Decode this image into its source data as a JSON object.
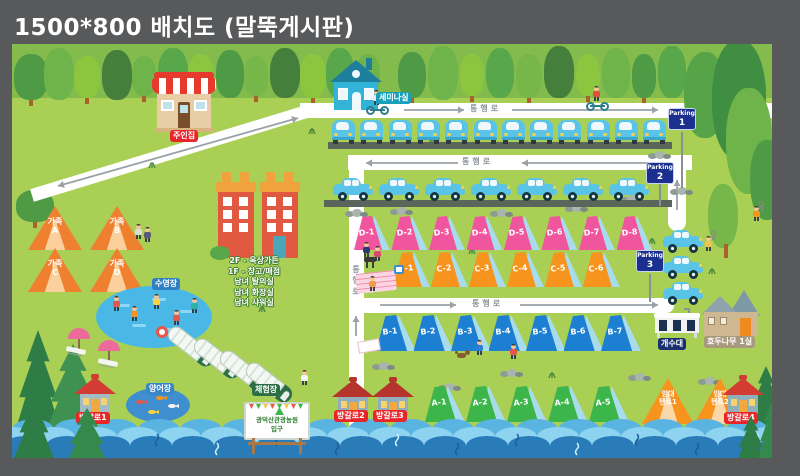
{
  "title": "1500*800 배치도 (말뚝게시판)",
  "road_label": "통행로",
  "parking": {
    "word": "Parking",
    "numbers": [
      "1",
      "2",
      "3"
    ]
  },
  "places": {
    "owner_house": "주인집",
    "seminar_room": "세미나실",
    "pool": "수영장",
    "fish_pond": "양어장",
    "experience_zone": "체험장",
    "sink_station": "개수대",
    "walnut_room": "호두나무 1실",
    "entrance_line1": "광덕산관광농원",
    "entrance_line2": "입구",
    "building_info": [
      "2F - 옥상가든",
      "1F - 창고/매점",
      "남녀 탈의실",
      "남녀 화장실",
      "남녀 샤워실"
    ],
    "bungalows": [
      "방갈로1",
      "방갈로2",
      "방갈로3",
      "방갈로4"
    ]
  },
  "tents": {
    "d": [
      "D-1",
      "D-2",
      "D-3",
      "D-4",
      "D-5",
      "D-6",
      "D-7",
      "D-8"
    ],
    "c": [
      "C-1",
      "C-2",
      "C-3",
      "C-4",
      "C-5",
      "C-6"
    ],
    "b": [
      "B-1",
      "B-2",
      "B-3",
      "B-4",
      "B-5",
      "B-6",
      "B-7"
    ],
    "a": [
      "A-1",
      "A-2",
      "A-3",
      "A-4",
      "A-5"
    ],
    "family": [
      {
        "top": "가족",
        "bottom": "A"
      },
      {
        "top": "가족",
        "bottom": "B"
      },
      {
        "top": "가족",
        "bottom": "C"
      },
      {
        "top": "가족",
        "bottom": "D"
      }
    ],
    "rental": [
      {
        "top": "임대",
        "bottom": "텐트1"
      },
      {
        "top": "임대",
        "bottom": "텐트2"
      }
    ]
  },
  "colors": {
    "background": "#58595b",
    "ground": "#a9cf55",
    "road": "#ffffff",
    "tent_d": "#f0569e",
    "tent_c": "#f7941e",
    "tent_b": "#1d7fd1",
    "tent_a": "#3cb54a",
    "tent_side": "#a8dcec",
    "family_tent": "#ef8030",
    "label_red": "#e8262a",
    "label_blue": "#2f80c3",
    "label_teal": "#18a0b8",
    "label_navy_parking": "#1b2f8e",
    "label_navy_sink": "#1b2f6e",
    "label_green": "#2a6e46",
    "label_tan": "#a89a7e",
    "river": "#3e9bd4"
  }
}
